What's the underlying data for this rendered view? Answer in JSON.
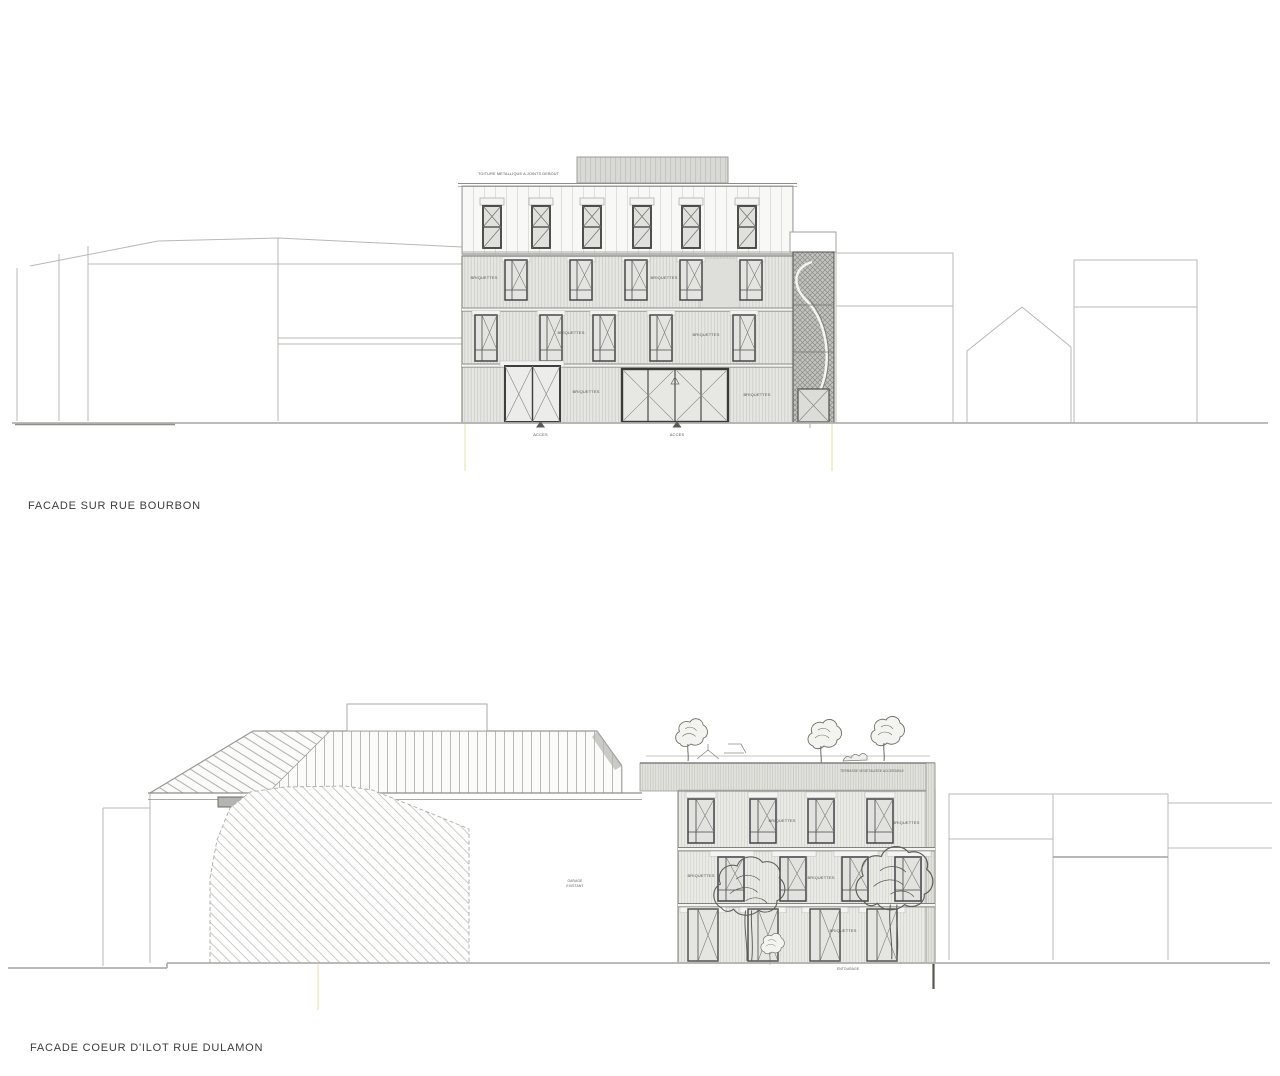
{
  "sheet": {
    "background": "#ffffff"
  },
  "facade1": {
    "title": "FACADE SUR RUE BOURBON",
    "roof_note": "TOITURE METALLIQUE A JOINTS DEBOUT",
    "material_label": "BRIQUETTES",
    "access_label": "ACCES"
  },
  "facade2": {
    "title": "FACADE COEUR D'ILOT RUE DULAMON",
    "material_label": "BRIQUETTES",
    "terrace_note": "TERRASSE VEGETALISEE ACCESSIBLE",
    "wall_note_line1": "GARAGE",
    "wall_note_line2": "EXISTANT",
    "ground_note": "ENTOURAGE"
  },
  "colors": {
    "property_limit": "#e8e2a2",
    "line_light": "#b8b8b4",
    "line_dark": "#4a4a48",
    "annotation": "#4e4e4a"
  }
}
